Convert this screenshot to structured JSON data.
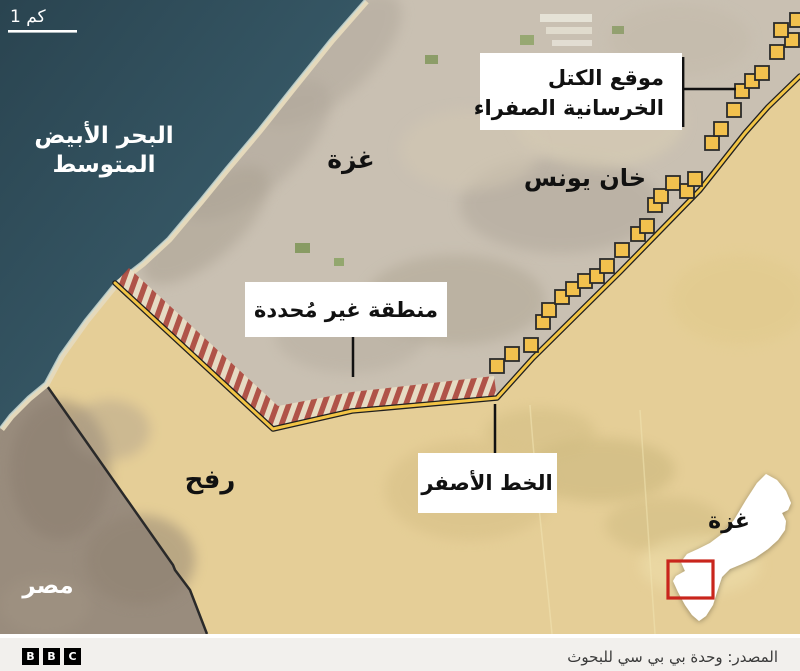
{
  "colors": {
    "sea": "#31505d",
    "sea_deep": "#2a4450",
    "land": "#c9c0b2",
    "urban": "#b1a89b",
    "sand": "#e5d9bb",
    "surf": "#ccdad4",
    "buffer": "#e7cf95",
    "egypt": "#998c7d",
    "yellow_line": "#f2c445",
    "line_outline": "#1f1f1f",
    "block_fill": "#f2c14e",
    "block_border": "#2b2b2b",
    "hatch_red": "#ae4a3f",
    "hatch_bg": "#e9ddc4",
    "leader": "#111111",
    "callout_bg": "#ffffff",
    "text_dark": "#111111",
    "text_light": "#ffffff",
    "inset_fill": "#ffffff",
    "inset_red": "#c9251c",
    "footer_bg": "#f2f0ed",
    "footer_text": "#3a3a3a",
    "logo_bg": "#000000",
    "logo_text": "#ffffff"
  },
  "scale": {
    "label": "1 كم"
  },
  "labels": {
    "sea_line1": "البحر الأبيض",
    "sea_line2": "المتوسط",
    "gaza": "غزة",
    "khan_younis": "خان يونس",
    "rafah": "رفح",
    "egypt": "مصر",
    "inset_gaza": "غزة"
  },
  "callouts": {
    "blocks": {
      "line1": "موقع الكتل",
      "line2": "الخرسانية الصفراء"
    },
    "undefined_area": {
      "label": "منطقة غير مُحددة"
    },
    "yellow_line": {
      "label": "الخط الأصفر"
    }
  },
  "map": {
    "block_size": 14,
    "blocks": [
      [
        497,
        366
      ],
      [
        512,
        354
      ],
      [
        531,
        345
      ],
      [
        543,
        322
      ],
      [
        549,
        310
      ],
      [
        562,
        297
      ],
      [
        573,
        289
      ],
      [
        585,
        281
      ],
      [
        597,
        276
      ],
      [
        607,
        266
      ],
      [
        622,
        250
      ],
      [
        638,
        234
      ],
      [
        647,
        226
      ],
      [
        655,
        205
      ],
      [
        661,
        196
      ],
      [
        673,
        183
      ],
      [
        687,
        191
      ],
      [
        695,
        179
      ],
      [
        712,
        143
      ],
      [
        721,
        129
      ],
      [
        734,
        110
      ],
      [
        742,
        91
      ],
      [
        752,
        81
      ],
      [
        762,
        73
      ],
      [
        777,
        52
      ],
      [
        792,
        40
      ],
      [
        781,
        30
      ],
      [
        797,
        20
      ]
    ]
  },
  "footer": {
    "source": "المصدر: وحدة بي بي سي للبحوث",
    "logo_letters": [
      "B",
      "B",
      "C"
    ]
  }
}
